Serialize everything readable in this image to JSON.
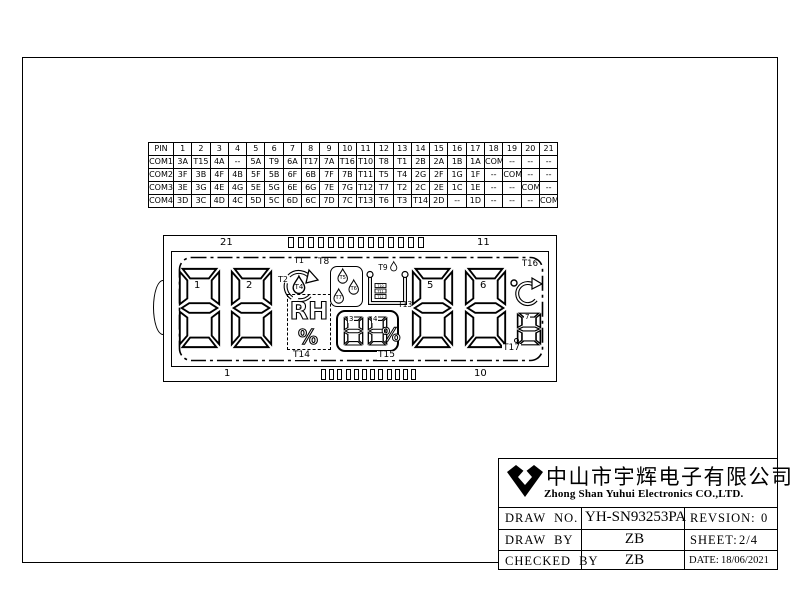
{
  "pin_table": {
    "header": "PIN",
    "pins": [
      "1",
      "2",
      "3",
      "4",
      "5",
      "6",
      "7",
      "8",
      "9",
      "10",
      "11",
      "12",
      "13",
      "14",
      "15",
      "16",
      "17",
      "18",
      "19",
      "20",
      "21"
    ],
    "rows": [
      {
        "label": "COM1",
        "cells": [
          "3A",
          "T15",
          "4A",
          "--",
          "5A",
          "T9",
          "6A",
          "T17",
          "7A",
          "T16",
          "T10",
          "T8",
          "T1",
          "2B",
          "2A",
          "1B",
          "1A",
          "COM1",
          "--",
          "--",
          "--"
        ]
      },
      {
        "label": "COM2",
        "cells": [
          "3F",
          "3B",
          "4F",
          "4B",
          "5F",
          "5B",
          "6F",
          "6B",
          "7F",
          "7B",
          "T11",
          "T5",
          "T4",
          "2G",
          "2F",
          "1G",
          "1F",
          "--",
          "COM2",
          "--",
          "--"
        ]
      },
      {
        "label": "COM3",
        "cells": [
          "3E",
          "3G",
          "4E",
          "4G",
          "5E",
          "5G",
          "6E",
          "6G",
          "7E",
          "7G",
          "T12",
          "T7",
          "T2",
          "2C",
          "2E",
          "1C",
          "1E",
          "--",
          "--",
          "COM3",
          "--"
        ]
      },
      {
        "label": "COM4",
        "cells": [
          "3D",
          "3C",
          "4D",
          "4C",
          "5D",
          "5C",
          "6D",
          "6C",
          "7D",
          "7C",
          "T13",
          "T6",
          "T3",
          "T14",
          "2D",
          "--",
          "1D",
          "--",
          "--",
          "--",
          "COM4"
        ]
      }
    ]
  },
  "lcd": {
    "corner_pins": {
      "top_left": "21",
      "top_right": "11",
      "bottom_left": "1",
      "bottom_right": "10"
    },
    "digit_labels": {
      "d1": "1",
      "d2": "2",
      "d3": "3",
      "d4": "4",
      "d5": "5",
      "d6": "6",
      "d7": "7"
    },
    "t_labels": {
      "t1": "T1",
      "t2": "T2",
      "t3": "T3",
      "t4": "T4",
      "t5": "T5",
      "t6": "T6",
      "t7": "T7",
      "t8": "T8",
      "t9": "T9",
      "t10": "T10",
      "t11": "T11",
      "t12": "T12",
      "t13": "T13",
      "t14": "T14",
      "t15": "T15",
      "t16": "T16",
      "t17": "T17"
    },
    "rh_text": "RH",
    "rh_percent": "%",
    "box_percent": "%",
    "celsius_letter": "C"
  },
  "title_block": {
    "company_cn": "中山市宇辉电子有限公司",
    "company_en": "Zhong Shan Yuhui Electronics CO.,LTD.",
    "draw_no_label": "DRAW NO.",
    "draw_no_value": "YH-SN93253PA",
    "revision_label": "REVSION:",
    "revision_value": "0",
    "draw_by_label": "DRAW BY",
    "draw_by_value": "ZB",
    "sheet_label": "SHEET:",
    "sheet_value": "2/4",
    "checked_by_label": "CHECKED BY",
    "checked_by_value": "ZB",
    "date_label": "DATE:",
    "date_value": "18/06/2021"
  }
}
